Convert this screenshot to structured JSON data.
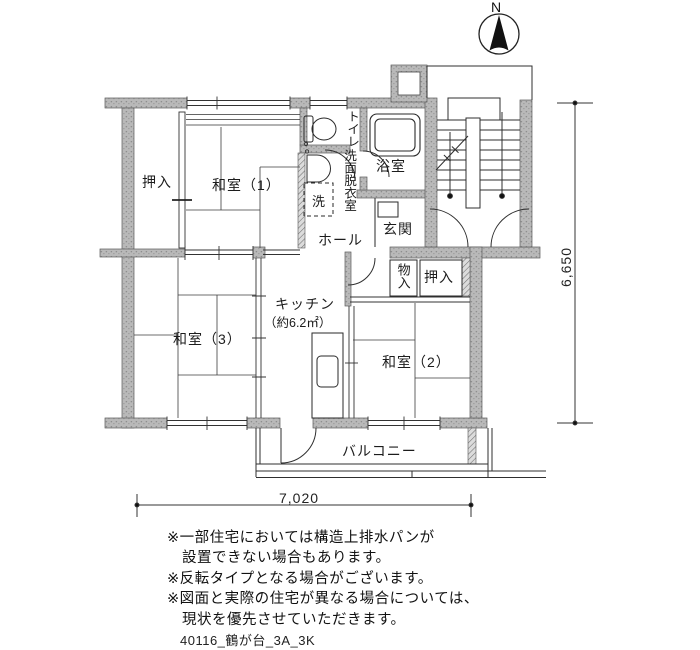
{
  "compass": {
    "north_label": "N"
  },
  "rooms": {
    "oshiire_upper": "押入",
    "washitsu1": "和室（1）",
    "toilet": "トイレ",
    "senmen_datsuiishitsu": "洗面脱衣室",
    "washing_machine": "洗",
    "bath": "浴室",
    "hall": "ホール",
    "genkan": "玄関",
    "mono_ire": "物入",
    "oshiire_right": "押入",
    "kitchen_name": "キッチン",
    "kitchen_area": "（約6.2㎡）",
    "washitsu3": "和室（3）",
    "washitsu2": "和室（2）",
    "balcony": "バルコニー"
  },
  "dimensions": {
    "width_mm": "7,020",
    "height_mm": "6,650"
  },
  "notes": [
    "※一部住宅においては構造上排水パンが",
    "　設置できない場合もあります。",
    "※反転タイプとなる場合がございます。",
    "※図面と実際の住宅が異なる場合については、",
    "　現状を優先させていただきます。"
  ],
  "footer": {
    "plan_id": "40116_鶴が台_3A_3K"
  },
  "colors": {
    "wall_fill": "#b8b8b8",
    "line": "#333333"
  }
}
